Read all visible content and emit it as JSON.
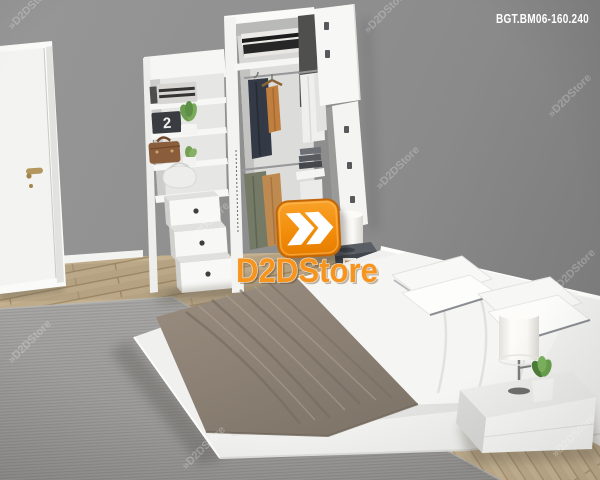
{
  "header": {
    "product_code": "BGT.BM06-160.240",
    "product_code_color": "#FFFFFF"
  },
  "brand": {
    "logo_text": "D2DStore",
    "logo_icon": "double-chevron-icon",
    "orange": "#F7941D",
    "orange_dark": "#E07B00",
    "chevron_color": "#FFFFFF"
  },
  "watermark": {
    "text_full": "»D2DStore",
    "color": "#FFFFFF",
    "opacity": 0.24
  },
  "scene": {
    "clock_digit": "2",
    "colors": {
      "wall": "#8E8E8E",
      "wood_floor": "#C4B190",
      "rug": "#A8A7A5",
      "blanket": "#95897D",
      "furniture_white": "#F4F4F2",
      "coat_navy": "#333A45",
      "jacket_olive": "#747A66",
      "jacket_tan": "#BF8A50",
      "briefcase_brown": "#8A5E3C",
      "handle_brass": "#B4975E"
    }
  }
}
